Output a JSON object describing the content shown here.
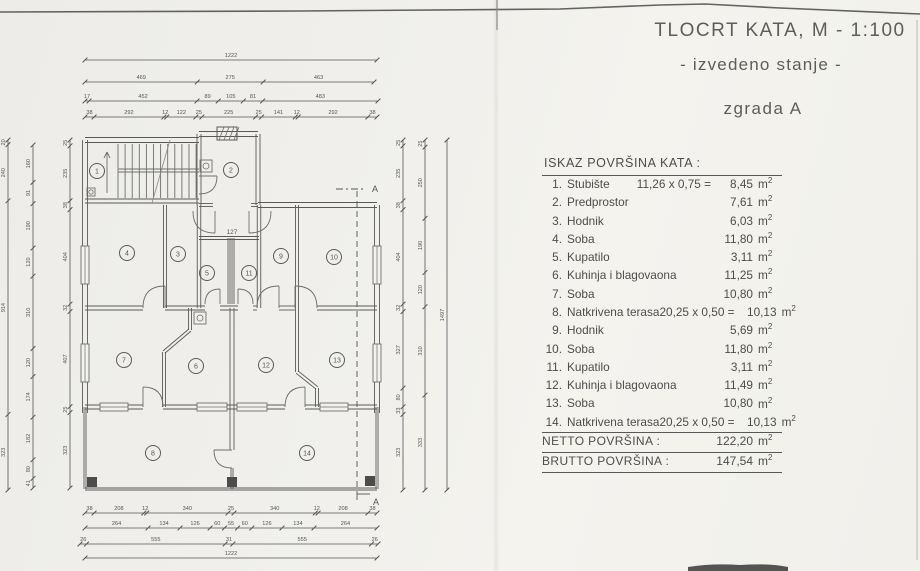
{
  "title": {
    "line1": "TLOCRT KATA, M - 1:100",
    "line2": "- izvedeno stanje -",
    "line3": "zgrada A"
  },
  "area_table": {
    "header": "ISKAZ POVRŠINA KATA :",
    "unit": "m",
    "unit_sup": "2",
    "items": [
      {
        "no": "1.",
        "name": "Stubište",
        "formula": "11,26 x 0,75 =",
        "value": "8,45"
      },
      {
        "no": "2.",
        "name": "Predprostor",
        "formula": "",
        "value": "7,61"
      },
      {
        "no": "3.",
        "name": "Hodnik",
        "formula": "",
        "value": "6,03"
      },
      {
        "no": "4.",
        "name": "Soba",
        "formula": "",
        "value": "11,80"
      },
      {
        "no": "5.",
        "name": "Kupatilo",
        "formula": "",
        "value": "3,11"
      },
      {
        "no": "6.",
        "name": "Kuhinja i blagovaona",
        "formula": "",
        "value": "11,25"
      },
      {
        "no": "7.",
        "name": "Soba",
        "formula": "",
        "value": "10,80"
      },
      {
        "no": "8.",
        "name": "Natkrivena terasa",
        "formula": "20,25 x 0,50 =",
        "value": "10,13"
      },
      {
        "no": "9.",
        "name": "Hodnik",
        "formula": "",
        "value": "5,69"
      },
      {
        "no": "10.",
        "name": "Soba",
        "formula": "",
        "value": "11,80"
      },
      {
        "no": "11.",
        "name": "Kupatilo",
        "formula": "",
        "value": "3,11"
      },
      {
        "no": "12.",
        "name": "Kuhinja i blagovaona",
        "formula": "",
        "value": "11,49"
      },
      {
        "no": "13.",
        "name": "Soba",
        "formula": "",
        "value": "10,80"
      },
      {
        "no": "14.",
        "name": "Natkrivena terasa",
        "formula": "20,25 x 0,50 =",
        "value": "10,13"
      }
    ],
    "totals": [
      {
        "label": "NETTO POVRŠINA :",
        "value": "122,20"
      },
      {
        "label": "BRUTTO POVRŠINA :",
        "value": "147,54"
      }
    ]
  },
  "plan": {
    "rooms": [
      {
        "n": "1",
        "x": 97,
        "y": 171
      },
      {
        "n": "2",
        "x": 231,
        "y": 170
      },
      {
        "n": "4",
        "x": 127,
        "y": 253
      },
      {
        "n": "3",
        "x": 178,
        "y": 254
      },
      {
        "n": "5",
        "x": 207,
        "y": 273
      },
      {
        "n": "11",
        "x": 249,
        "y": 273
      },
      {
        "n": "9",
        "x": 281,
        "y": 256
      },
      {
        "n": "10",
        "x": 334,
        "y": 257
      },
      {
        "n": "7",
        "x": 124,
        "y": 360
      },
      {
        "n": "6",
        "x": 196,
        "y": 366
      },
      {
        "n": "12",
        "x": 266,
        "y": 365
      },
      {
        "n": "13",
        "x": 337,
        "y": 360
      },
      {
        "n": "8",
        "x": 153,
        "y": 453
      },
      {
        "n": "14",
        "x": 307,
        "y": 453
      }
    ],
    "labels": [
      {
        "t": "127",
        "x": 232,
        "y": 234,
        "s": 6.5
      },
      {
        "t": "A",
        "x": 375,
        "y": 192,
        "s": 9
      },
      {
        "t": "A",
        "x": 376,
        "y": 505,
        "s": 9
      }
    ],
    "dims": {
      "top": [
        {
          "y": 60,
          "x0": 85,
          "x1": 377,
          "segs": [
            "1222"
          ]
        },
        {
          "y": 82,
          "x0": 85,
          "x1": 374,
          "segs": [
            "469",
            "275",
            "463"
          ]
        },
        {
          "y": 101,
          "x0": 85,
          "x1": 378,
          "segs": [
            "17",
            "452",
            "89",
            "105",
            "81",
            "483"
          ]
        },
        {
          "y": 117,
          "x0": 85,
          "x1": 377,
          "segs": [
            "38",
            "292",
            "12",
            "122",
            "25",
            "225",
            "25",
            "141",
            "12",
            "292",
            "38"
          ]
        }
      ],
      "bottom": [
        {
          "y": 513,
          "x0": 85,
          "x1": 377,
          "segs": [
            "38",
            "208",
            "12",
            "340",
            "25",
            "340",
            "12",
            "208",
            "38"
          ]
        },
        {
          "y": 528,
          "x0": 85,
          "x1": 377,
          "segs": [
            "264",
            "134",
            "126",
            "60",
            "55",
            "60",
            "126",
            "134",
            "264"
          ]
        },
        {
          "y": 544,
          "x0": 80,
          "x1": 378,
          "segs": [
            "26",
            "555",
            "31",
            "555",
            "26"
          ]
        },
        {
          "y": 558,
          "x0": 85,
          "x1": 377,
          "segs": [
            "1222"
          ]
        }
      ],
      "left": [
        {
          "x": 8,
          "y0": 140,
          "y1": 490,
          "segs": [
            "20",
            "240",
            "914",
            "323"
          ]
        },
        {
          "x": 33,
          "y0": 145,
          "y1": 488,
          "segs": [
            "160",
            "91",
            "190",
            "120",
            "310",
            "120",
            "174",
            "182",
            "80",
            "41"
          ]
        },
        {
          "x": 70,
          "y0": 140,
          "y1": 488,
          "segs": [
            "25",
            "235",
            "38",
            "404",
            "32",
            "407",
            "25",
            "323"
          ]
        }
      ],
      "right": [
        {
          "x": 403,
          "y0": 140,
          "y1": 490,
          "segs": [
            "25",
            "235",
            "38",
            "404",
            "32",
            "327",
            "80",
            "33",
            "323"
          ]
        },
        {
          "x": 425,
          "y0": 140,
          "y1": 490,
          "segs": [
            "25",
            "250",
            "190",
            "120",
            "310",
            "333"
          ]
        },
        {
          "x": 447,
          "y0": 140,
          "y1": 490,
          "segs": [
            "1497"
          ]
        }
      ]
    }
  }
}
